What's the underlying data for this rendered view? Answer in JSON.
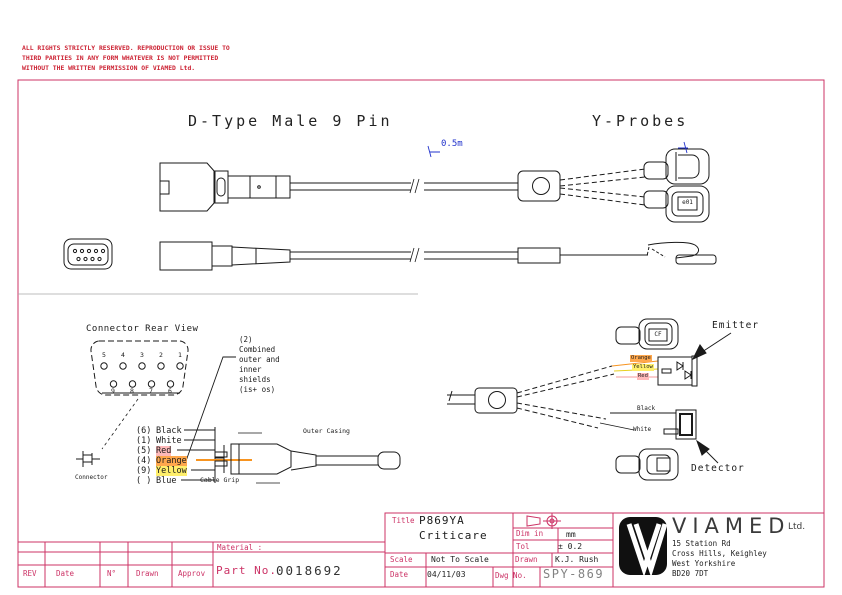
{
  "page": {
    "copyright": "ALL RIGHTS STRICTLY RESERVED. REPRODUCTION OR ISSUE TO\nTHIRD PARTIES IN ANY FORM WHATEVER IS NOT PERMITTED\nWITHOUT THE WRITTEN PERMISSION OF VIAMED Ltd.",
    "accent_color": "#cc3366",
    "dimension_color": "#2233cc"
  },
  "titles": {
    "left": "D-Type Male 9 Pin",
    "right": "Y-Probes"
  },
  "drawing": {
    "cable_length": "0.5m",
    "probe_tag": "e01",
    "probe_tag2": "CF",
    "rear_view_title": "Connector Rear View",
    "pins_top": [
      "5",
      "4",
      "3",
      "2",
      "1"
    ],
    "pins_bottom": [
      "9",
      "8",
      "7",
      "6"
    ],
    "shield_note": "(2)\nCombined\nouter and\ninner\nshields\n(is+ os)",
    "wires": [
      {
        "pin": "(6)",
        "color": "Black"
      },
      {
        "pin": "(1)",
        "color": "White"
      },
      {
        "pin": "(5)",
        "color": "Red"
      },
      {
        "pin": "(4)",
        "color": "Orange"
      },
      {
        "pin": "(9)",
        "color": "Yellow"
      },
      {
        "pin": "( )",
        "color": "Blue"
      }
    ],
    "labels": {
      "connector": "Connector",
      "cable_grip": "Cable Grip",
      "outer_casing": "Outer Casing",
      "emitter": "Emitter",
      "detector": "Detector",
      "emitter_wires": [
        "Orange",
        "Yellow",
        "Red"
      ],
      "detector_wires": [
        "Black",
        "White"
      ]
    },
    "wire_colors": {
      "orange": "#ffa84d",
      "yellow": "#ffef6b",
      "red": "#ffb9b9"
    }
  },
  "title_block": {
    "title_label": "Title",
    "title_value_line1": "P869YA",
    "title_value_line2": "Criticare",
    "dim_label": "Dim in",
    "dim_value": "mm",
    "tol_label": "Tol",
    "tol_value": "± 0.2",
    "scale_label": "Scale",
    "scale_value": "Not To Scale",
    "drawn_label": "Drawn",
    "drawn_value": "K.J. Rush",
    "date_label": "Date",
    "date_value": "04/11/03",
    "dwg_label": "Dwg No.",
    "dwg_value": "SPY-869"
  },
  "rev_table": {
    "headers": [
      "REV",
      "Date",
      "N°",
      "Drawn",
      "Approv"
    ],
    "material_label": "Material :",
    "part_label": "Part No.",
    "part_value": "0018692"
  },
  "company": {
    "name": "VIAMED",
    "suffix": "Ltd.",
    "address_block": "15 Station Rd\nCross Hills, Keighley\nWest Yorkshire\nBD20 7DT"
  }
}
